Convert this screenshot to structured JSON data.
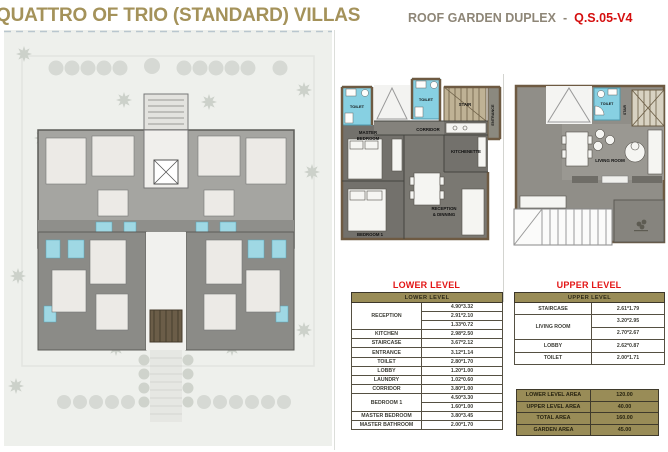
{
  "header": {
    "title": "QUATTRO OF TRIO (STANDARD) VILLAS",
    "subtitle": "ROOF GARDEN DUPLEX",
    "separator": "-",
    "code": "Q.S.05-V4"
  },
  "colors": {
    "brand_khaki": "#998c57",
    "title_tan": "#a4925a",
    "accent_red": "#d50f0f",
    "plan_floor_gray": "#73716c",
    "bathroom_cyan": "#87d0e2"
  },
  "lower_plan": {
    "labels": {
      "toilet_left": "TOILET",
      "toilet_mid": "TOILET",
      "stair": "STAIR",
      "entrance": "ENTRANCE",
      "corridor": "CORRIDOR",
      "master_line1": "MASTER",
      "master_line2": "BEDROOM",
      "kitchenette": "KITCHENETTE",
      "reception_line1": "RECEPTION",
      "reception_line2": "& DINNING",
      "bedroom1": "BEDROOM 1"
    }
  },
  "upper_plan": {
    "labels": {
      "toilet": "TOILET",
      "stair": "STAIR",
      "living_room": "LIVING ROOM"
    }
  },
  "lower_table": {
    "title": "LOWER LEVEL",
    "header": "LOWER LEVEL",
    "rows": [
      {
        "label": "RECEPTION",
        "values": [
          "4.90*3.32",
          "2.91*2.10",
          "1.33*0.72"
        ]
      },
      {
        "label": "KITCHEN",
        "values": [
          "2.98*2.50"
        ]
      },
      {
        "label": "STAIRCASE",
        "values": [
          "3.67*2.12"
        ]
      },
      {
        "label": "ENTRANCE",
        "values": [
          "3.12*1.14"
        ]
      },
      {
        "label": "TOILET",
        "values": [
          "2.80*1.70"
        ]
      },
      {
        "label": "LOBBY",
        "values": [
          "1.20*1.00"
        ]
      },
      {
        "label": "LAUNDRY",
        "values": [
          "1.02*0.60"
        ]
      },
      {
        "label": "CORRIDOR",
        "values": [
          "3.80*1.00"
        ]
      },
      {
        "label": "BEDROOM 1",
        "values": [
          "4.50*3.30",
          "1.60*1.00"
        ]
      },
      {
        "label": "MASTER BEDROOM",
        "values": [
          "3.80*3.45"
        ]
      },
      {
        "label": "MASTER BATHROOM",
        "values": [
          "2.00*1.70"
        ]
      }
    ]
  },
  "upper_table": {
    "title": "UPPER LEVEL",
    "header": "UPPER LEVEL",
    "rows": [
      {
        "label": "STAIRCASE",
        "values": [
          "2.61*1.79"
        ]
      },
      {
        "label": "LIVING ROOM",
        "values": [
          "3.20*2.95",
          "2.70*2.67"
        ]
      },
      {
        "label": "LOBBY",
        "values": [
          "2.62*0.87"
        ]
      },
      {
        "label": "TOILET",
        "values": [
          "2.00*1.71"
        ]
      }
    ]
  },
  "area_table": {
    "rows": [
      {
        "label": "LOWER LEVEL AREA",
        "value": "120.00"
      },
      {
        "label": "UPPER LEVEL AREA",
        "value": "40.00"
      },
      {
        "label": "TOTAL AREA",
        "value": "160.00"
      },
      {
        "label": "GARDEN AREA",
        "value": "45.00"
      }
    ]
  }
}
